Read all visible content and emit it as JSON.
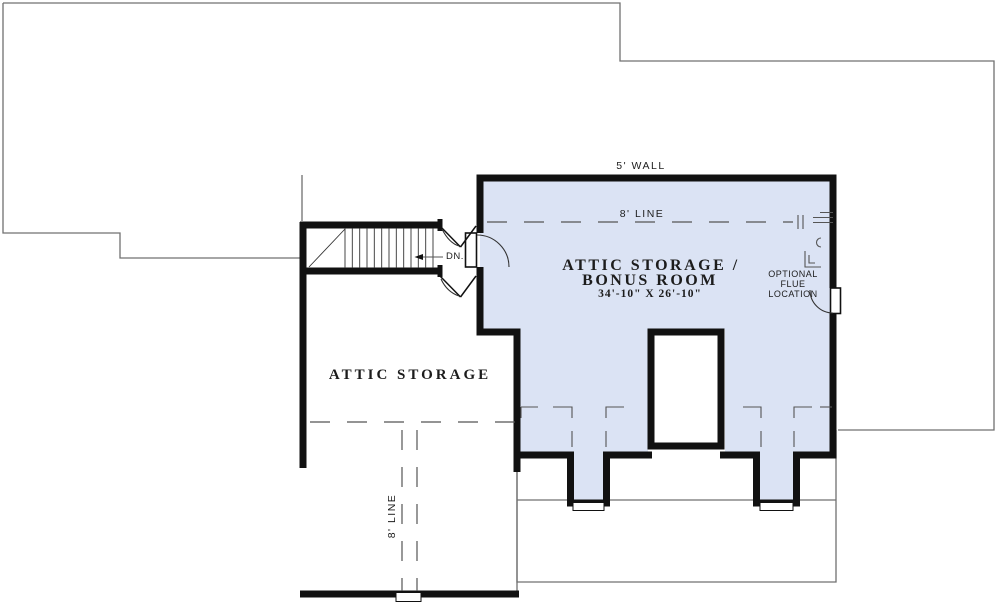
{
  "plan": {
    "bonus_room": {
      "name_line1": "ATTIC STORAGE /",
      "name_line2": "BONUS ROOM",
      "dimensions": "34'-10\" X 26'-10\""
    },
    "attic_storage": {
      "name": "ATTIC STORAGE"
    },
    "annotations": {
      "wall_height": "5' WALL",
      "ceiling_line_bonus": "8' LINE",
      "ceiling_line_attic": "8' LINE",
      "stairs_direction": "DN.",
      "flue_line1": "OPTIONAL",
      "flue_line2": "FLUE",
      "flue_line3": "LOCATION"
    }
  },
  "colors": {
    "room_fill": "#dbe3f4",
    "wall": "#111111",
    "outline": "#707070",
    "dash": "#555555",
    "text": "#1c1c1c"
  }
}
